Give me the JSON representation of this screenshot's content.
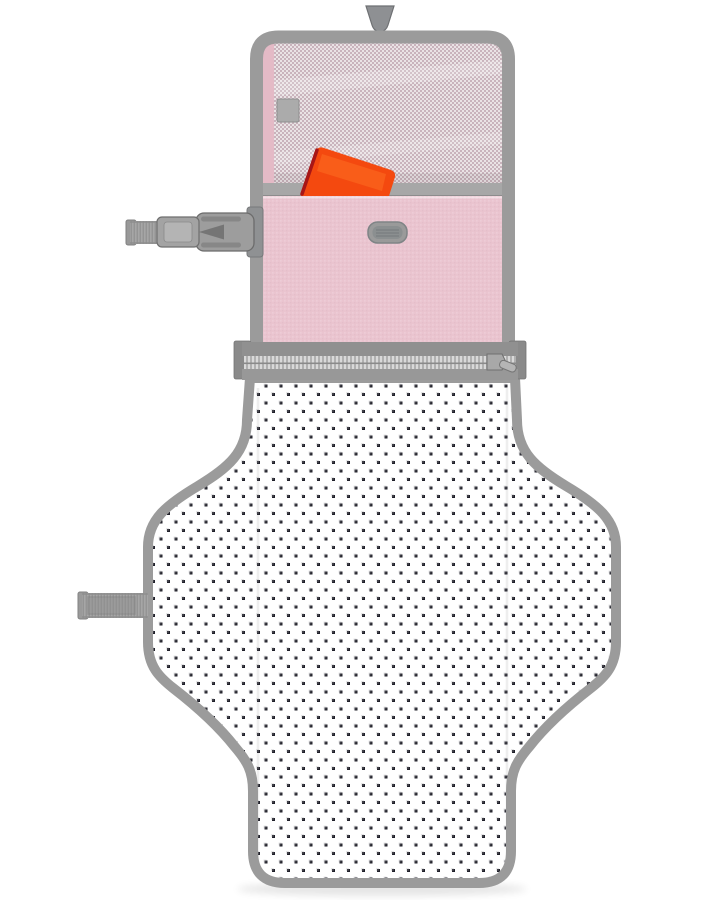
{
  "scene": {
    "type": "product-photo",
    "subject": "portable baby changing pad, open and hanging, with mesh pocket, pink zip pouch and polka-dot mat",
    "visible_text": "",
    "background_color": "#ffffff"
  },
  "colors": {
    "binding_gray": "#9b9b9b",
    "binding_gray_dark": "#7e8082",
    "hanger_gray": "#8e9093",
    "webbing_gray": "#a6a6a6",
    "buckle_gray": "#9d9d9d",
    "mesh_pink": "#c9b3bc",
    "mesh_net": "#eee8ea",
    "panel_pink": "#e4bac6",
    "flap_pink": "#eac4cf",
    "pocket_edge_gray": "#a7a7a7",
    "orange_item": "#f4490f",
    "orange_item_edge": "#a81616",
    "zipper_tape": "#909090",
    "zipper_teeth": "#d9d9d9",
    "mat_white": "#ffffff",
    "dot_navy": "#20202a",
    "patch_gray": "#9a9a9a"
  },
  "texture": {
    "polka_dot_pitch_x": 15,
    "polka_dot_pitch_y": 17,
    "polka_dot_size": 3
  },
  "parts": [
    "hanger-tab",
    "mesh-pocket",
    "mesh-pocket-tab",
    "orange-wipes-case",
    "pink-front-flap",
    "brand-patch",
    "side-release-buckle",
    "buckle-strap",
    "zipper",
    "zipper-pull",
    "changing-mat",
    "attachment-strap"
  ]
}
